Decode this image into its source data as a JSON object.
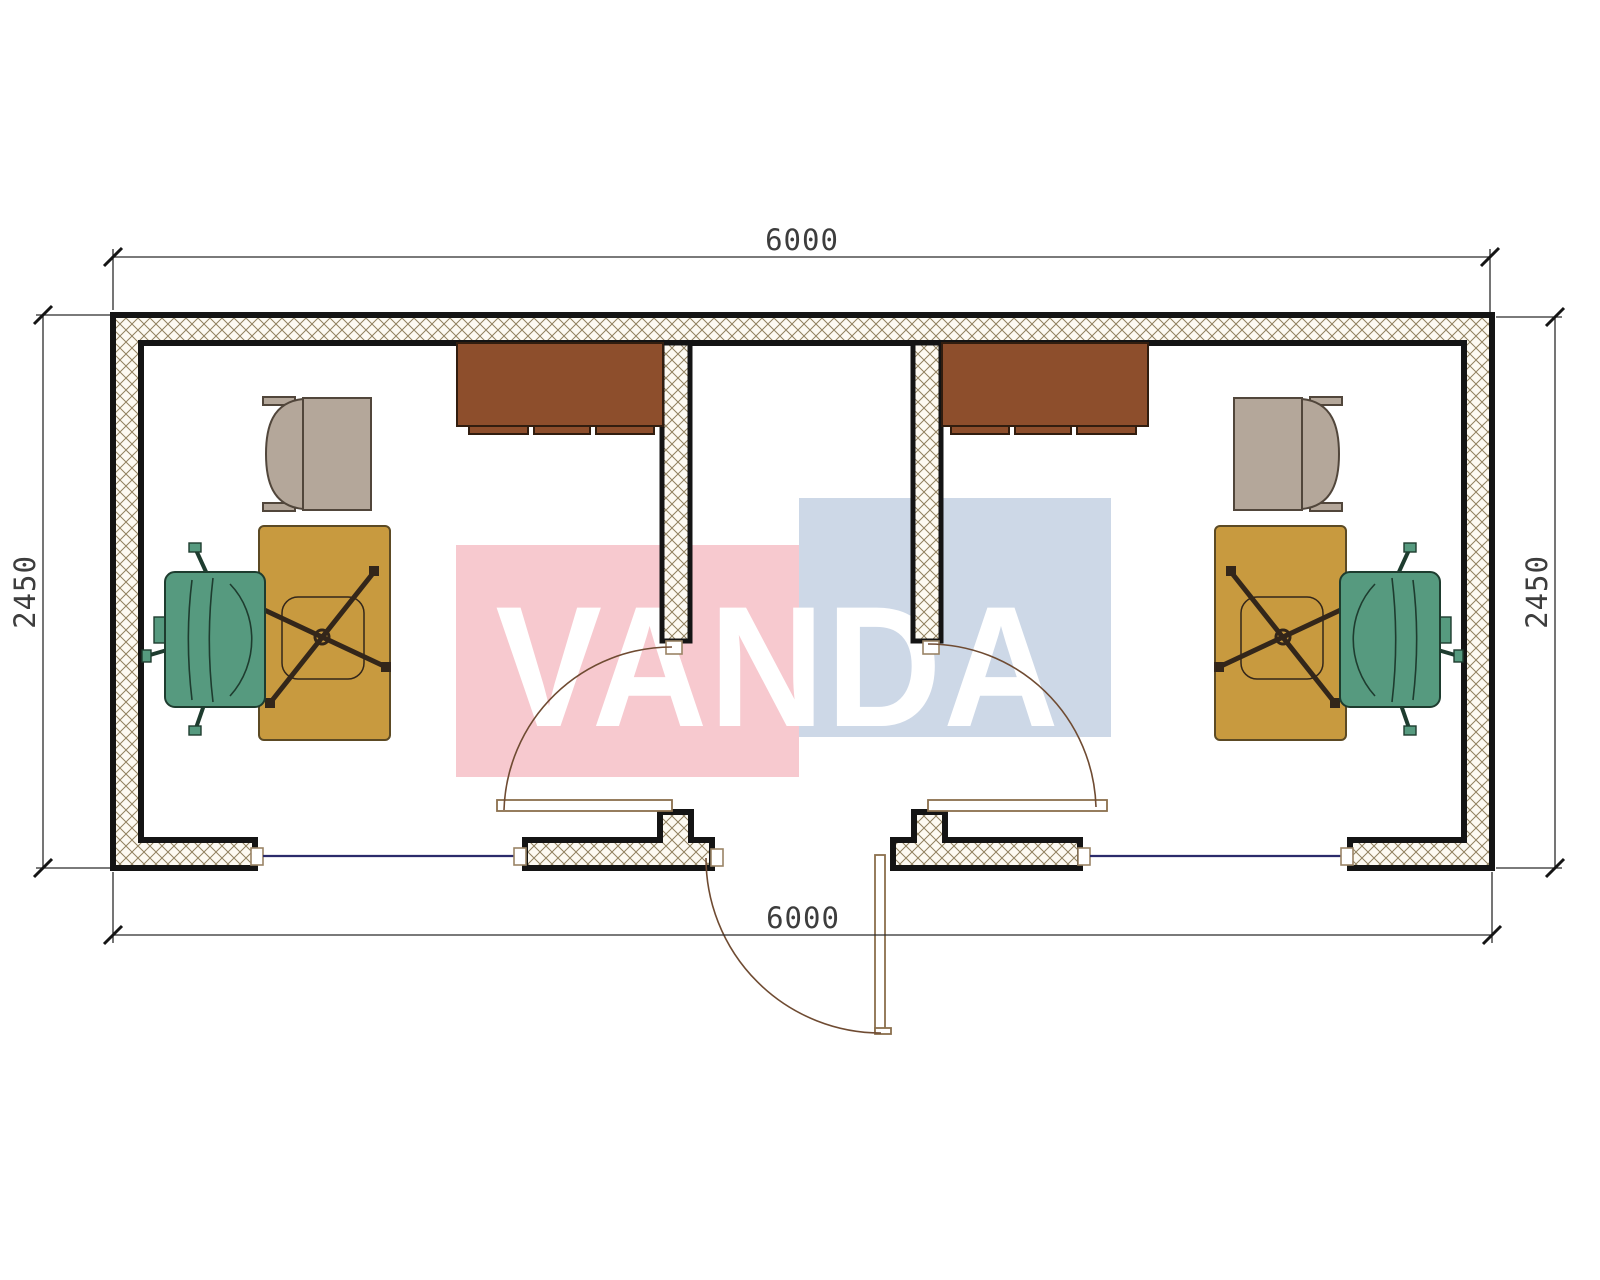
{
  "watermark": {
    "text": "VANDA"
  },
  "dimensions": {
    "top": "6000",
    "bottom": "6000",
    "left": "2450",
    "right": "2450"
  },
  "colors": {
    "background": "#ffffff",
    "wall_line": "#141414",
    "hatch_line": "#90805e",
    "hatch_bg": "#fdfaf2",
    "window_line": "#2b2b6b",
    "jamb_line": "#9a8465",
    "door_line": "#8a6f4d",
    "door_arc": "#6f4b32",
    "cabinet": "#8d4e2c",
    "cabinet_line": "#311d0f",
    "desk": "#c89a3f",
    "desk_line": "#5c4a24",
    "star": "#33261a",
    "armchair": "#b4a79a",
    "armchair_line": "#51463b",
    "chair": "#569a7f",
    "chair_line": "#1e3c2f",
    "dim_line": "#2b2b2b",
    "dim_text": "#3d3d3d",
    "watermark_pink": "#f7c9cf",
    "watermark_blue": "#cdd8e7",
    "watermark_text": "#ffffff"
  }
}
